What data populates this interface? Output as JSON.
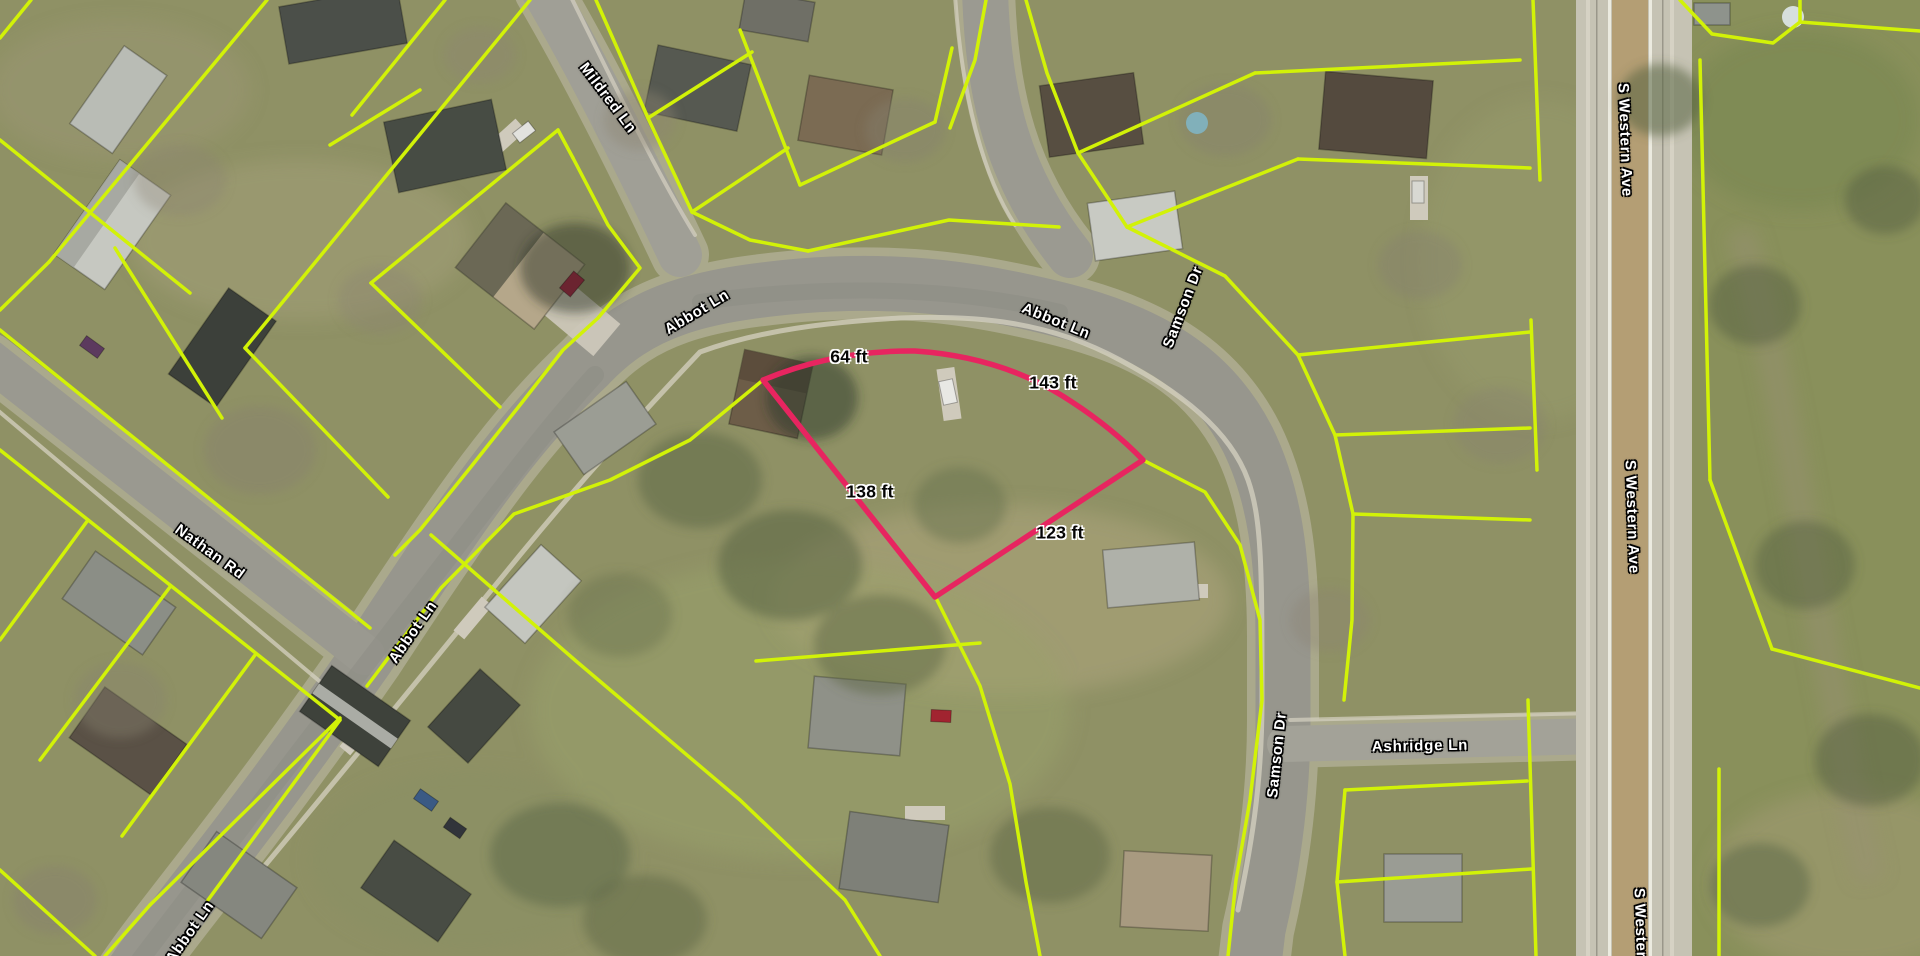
{
  "map": {
    "view": "aerial-parcel-map",
    "street_labels": [
      {
        "text": "Mildred Ln"
      },
      {
        "text": "Abbot Ln"
      },
      {
        "text": "Abbot Ln"
      },
      {
        "text": "Samson Dr"
      },
      {
        "text": "Nathan Rd"
      },
      {
        "text": "Abbot Ln"
      },
      {
        "text": "Abbot Ln"
      },
      {
        "text": "Samson Dr"
      },
      {
        "text": "Ashridge Ln"
      },
      {
        "text": "S Western Ave"
      },
      {
        "text": "S Western Ave"
      },
      {
        "text": "S Western Ave"
      }
    ],
    "dimension_labels": [
      {
        "text": "64 ft"
      },
      {
        "text": "143 ft"
      },
      {
        "text": "138 ft"
      },
      {
        "text": "123 ft"
      }
    ],
    "highlighted_parcel": {
      "outline_color": "#e72560",
      "side_lengths_ft": [
        64,
        143,
        138,
        123
      ]
    },
    "colors": {
      "parcel_lines": "#d2f207",
      "road": "#98978e",
      "grass": "#8f9165",
      "highway_median": "#b49e74"
    }
  }
}
